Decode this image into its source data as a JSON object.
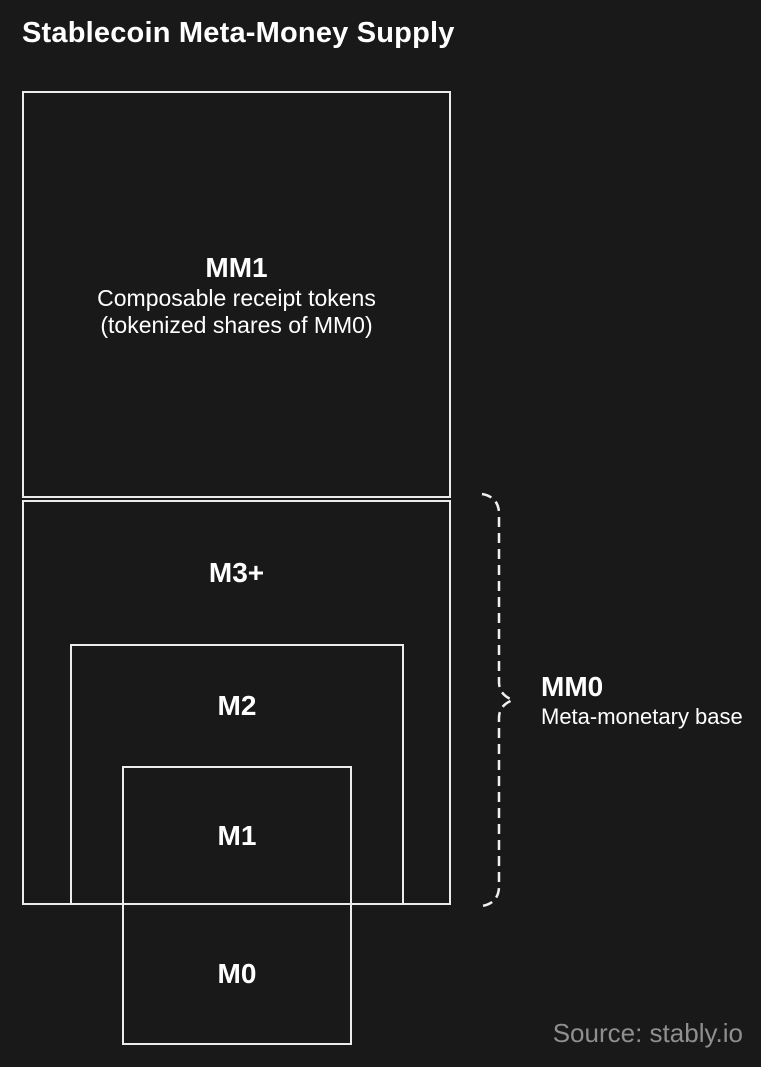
{
  "title": "Stablecoin Meta-Money Supply",
  "colors": {
    "background": "#191919",
    "box_border": "#ececec",
    "text": "#ffffff",
    "source_text": "#8f8f8f"
  },
  "boxes": {
    "mm1": {
      "label": "MM1",
      "desc_line1": "Composable receipt tokens",
      "desc_line2": "(tokenized shares of MM0)"
    },
    "m3": {
      "label": "M3+"
    },
    "m2": {
      "label": "M2"
    },
    "m1": {
      "label": "M1"
    },
    "m0": {
      "label": "M0"
    }
  },
  "brace_annotation": {
    "label": "MM0",
    "sublabel": "Meta-monetary base"
  },
  "source": "Source: stably.io"
}
